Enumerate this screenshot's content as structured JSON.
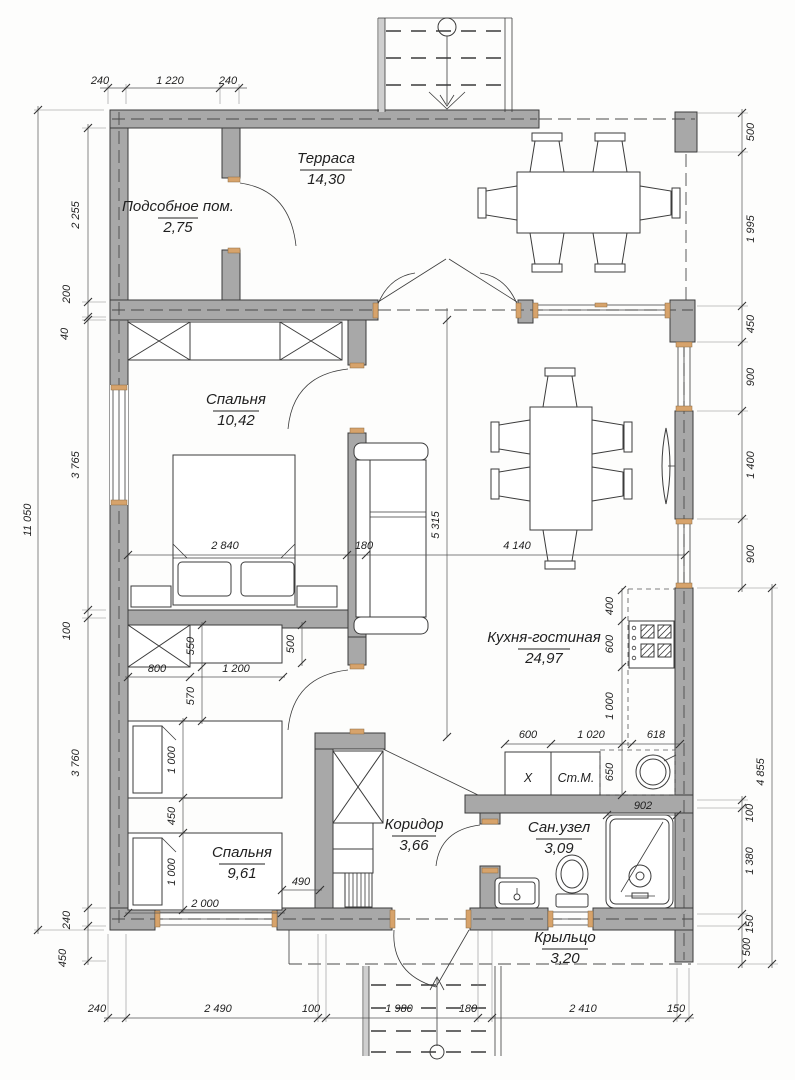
{
  "drawing": {
    "rooms": [
      {
        "name": "Терраса",
        "area": "14,30"
      },
      {
        "name": "Подсобное пом.",
        "area": "2,75"
      },
      {
        "name": "Спальня",
        "area": "10,42"
      },
      {
        "name": "Кухня-гостиная",
        "area": "24,97"
      },
      {
        "name": "Спальня",
        "area": "9,61"
      },
      {
        "name": "Коридор",
        "area": "3,66"
      },
      {
        "name": "Сан.узел",
        "area": "3,09"
      },
      {
        "name": "Крыльцо",
        "area": "3,20"
      }
    ],
    "appliances": {
      "box_x": "X",
      "washer": "Ст.М."
    },
    "dims": {
      "top": [
        "240",
        "1 220",
        "240"
      ],
      "left_total": "11 050",
      "left": [
        "2 255",
        "200",
        "40",
        "3 765",
        "100",
        "3 760",
        "240",
        "450"
      ],
      "right": [
        "500",
        "1 995",
        "450",
        "900",
        "1 400",
        "900"
      ],
      "right_lower_total": "4 855",
      "right_lower": [
        "100",
        "1 380",
        "150",
        "500"
      ],
      "bottom": [
        "240",
        "2 490",
        "100",
        "1 980",
        "180",
        "2 410",
        "150"
      ],
      "interior": {
        "bed_w": "2 840",
        "wall": "180",
        "living_w": "4 140",
        "living_h": "5 315",
        "k1": "400",
        "k2": "600",
        "k3": "1 000",
        "k4": "650",
        "kb1": "600",
        "kb2": "1 020",
        "kb3": "618",
        "shower_w": "902",
        "w_depth": "550",
        "gap": "570",
        "desk_depth": "500",
        "w_w": "800",
        "desk_w": "1 200",
        "bed1": "1 000",
        "bedgap": "450",
        "bed2": "1 000",
        "bedlen": "2 000",
        "door_gap": "490"
      }
    },
    "colors": {
      "wall": "#a8a8a8",
      "line": "#3b3b3b",
      "accent": "#d7a36b"
    }
  }
}
